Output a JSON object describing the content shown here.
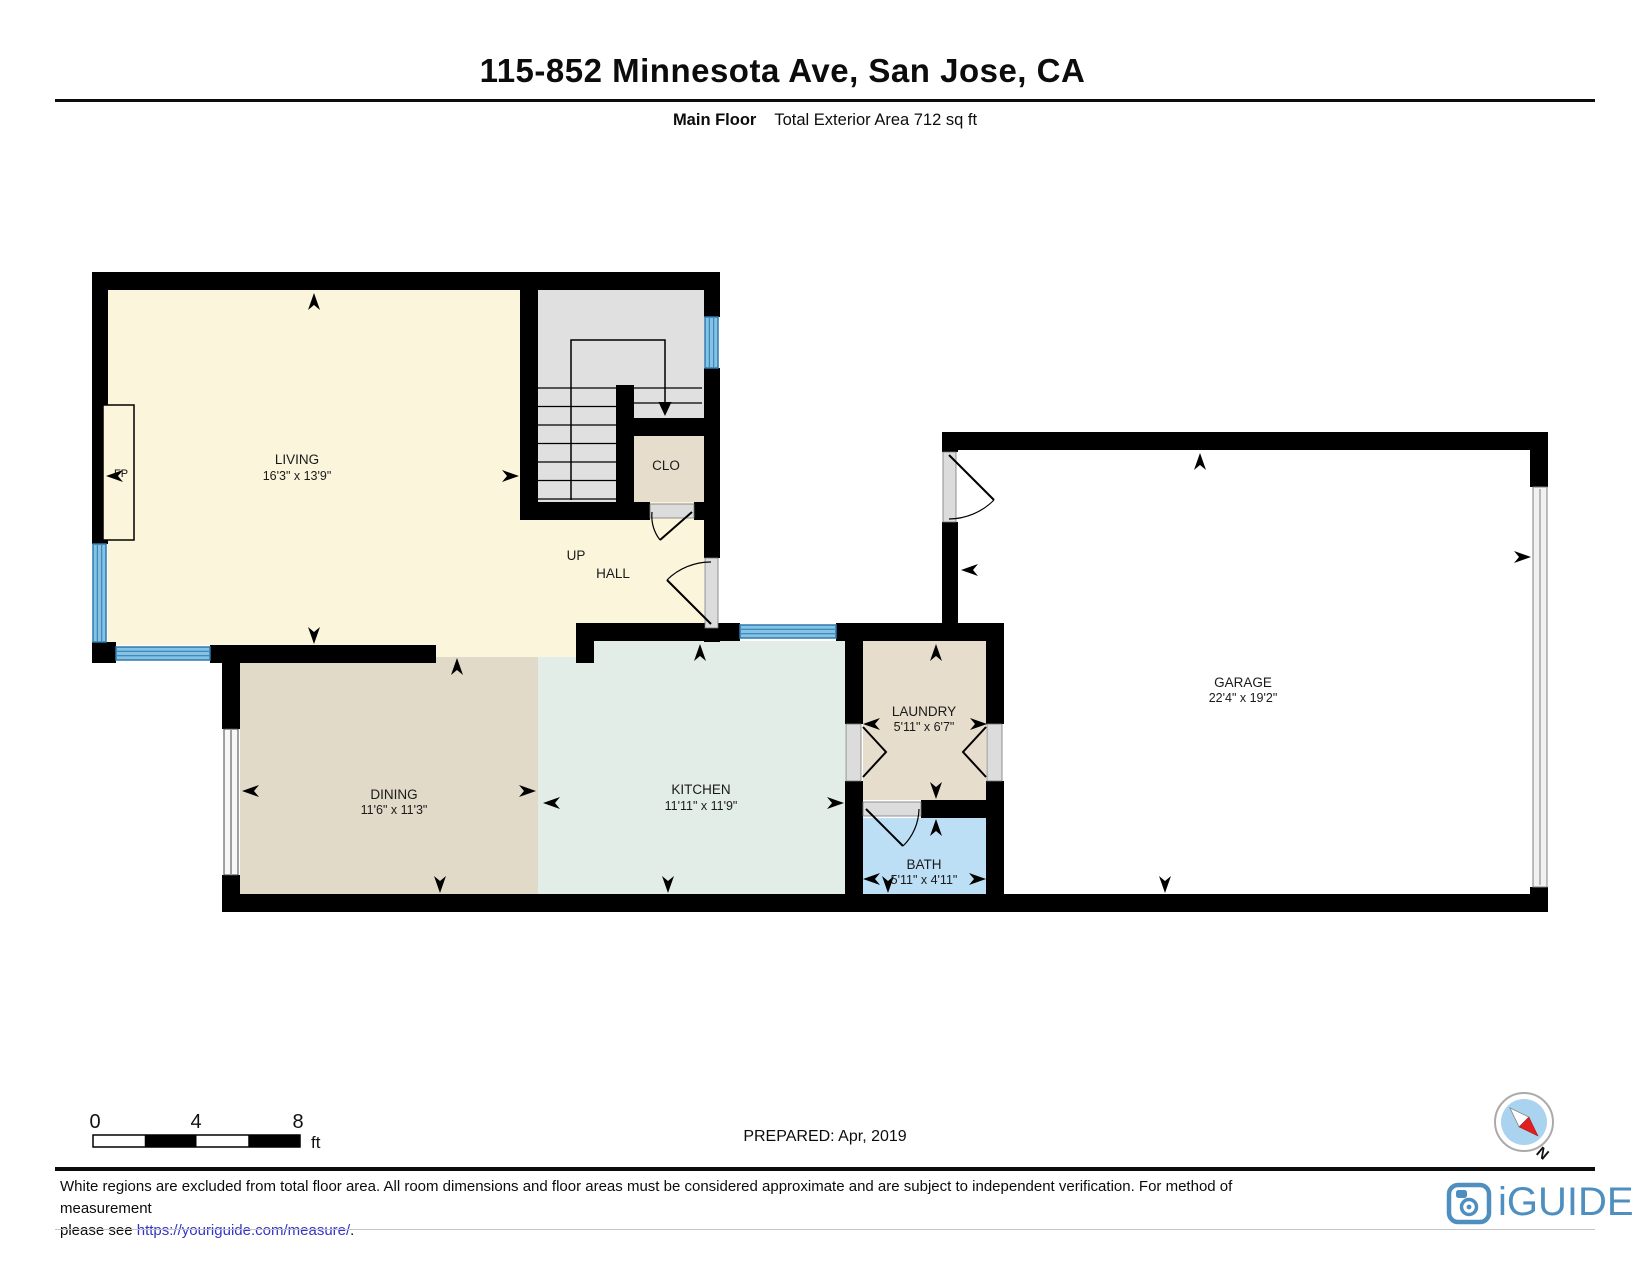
{
  "header": {
    "title": "115-852 Minnesota Ave, San Jose, CA",
    "floor_label": "Main Floor",
    "area_label": "Total Exterior Area 712 sq ft"
  },
  "rooms": {
    "living": {
      "name": "LIVING",
      "dims": "16'3\" x 13'9\""
    },
    "dining": {
      "name": "DINING",
      "dims": "11'6\" x 11'3\""
    },
    "kitchen": {
      "name": "KITCHEN",
      "dims": "11'11\" x 11'9\""
    },
    "laundry": {
      "name": "LAUNDRY",
      "dims": "5'11\" x 6'7\""
    },
    "bath": {
      "name": "BATH",
      "dims": "5'11\" x 4'11\""
    },
    "garage": {
      "name": "GARAGE",
      "dims": "22'4\" x 19'2\""
    },
    "closet": {
      "name": "CLO"
    },
    "hall": {
      "name": "HALL"
    },
    "stairs_up": {
      "name": "UP"
    },
    "fireplace": {
      "name": "FP"
    }
  },
  "scale_bar": {
    "ticks": [
      "0",
      "4",
      "8"
    ],
    "unit": "ft"
  },
  "prepared_label": "PREPARED: Apr, 2019",
  "compass": {
    "label": "N"
  },
  "footer": {
    "line1": "White regions are excluded from total floor area. All room dimensions and floor areas must be considered approximate and are subject to independent verification. For method of measurement",
    "line2_prefix": "please see ",
    "link": "https://youriguide.com/measure/",
    "line2_suffix": ".",
    "logo_text": "iGUIDE"
  },
  "colors": {
    "wall": "#000000",
    "living_fill": "#FBF5DC",
    "dining_fill": "#E2DAC8",
    "kitchen_fill": "#E1EDE6",
    "closet_laundry_fill": "#E6DDCC",
    "bath_fill": "#BDDFF6",
    "stairs_fill": "#E0E0E0",
    "window_fill": "#85C3E6",
    "window_frame": "#2E79AC",
    "threshold_fill": "#DCDCDC",
    "link_blue": "#3333CC",
    "logo_blue": "#4E8FBF",
    "compass_blue": "#A9D3EE",
    "compass_red": "#E02020"
  }
}
